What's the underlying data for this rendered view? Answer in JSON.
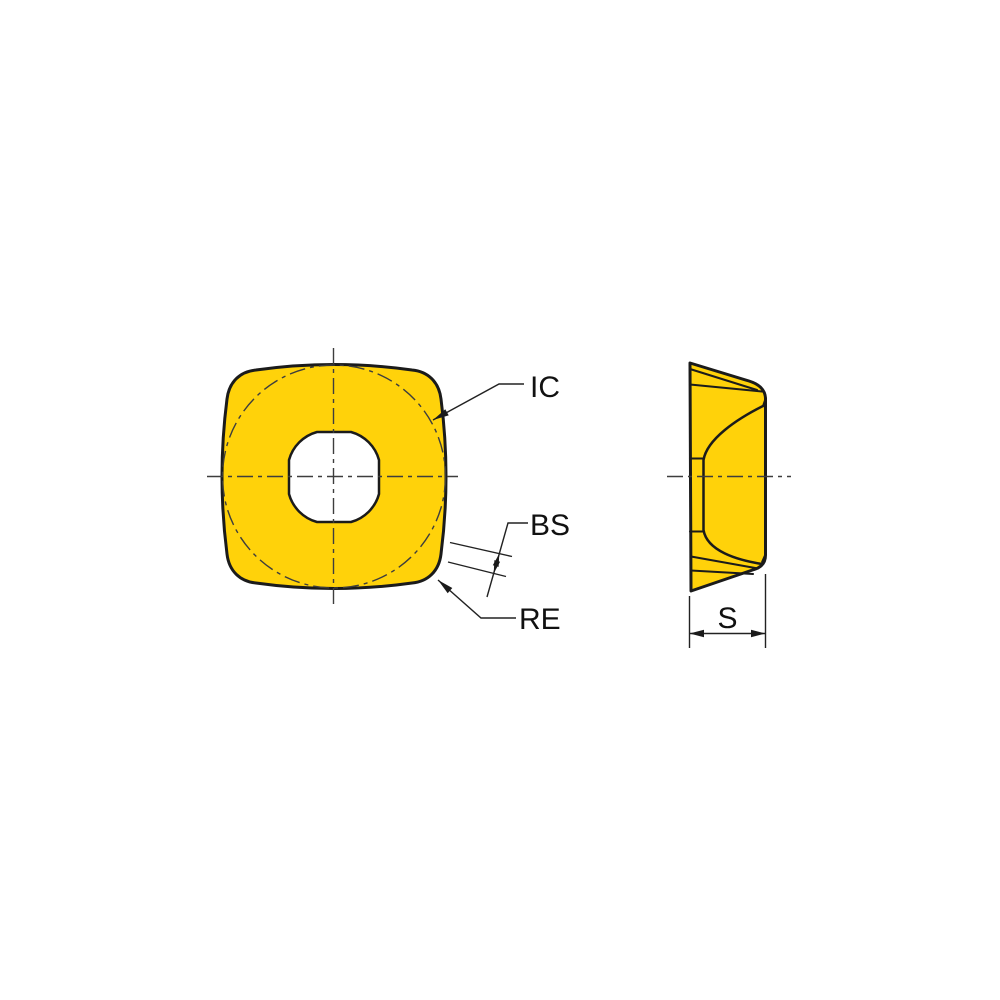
{
  "drawing": {
    "labels": {
      "ic": "IC",
      "bs": "BS",
      "re": "RE",
      "s": "S"
    },
    "colors": {
      "insert_fill": "#FFD20A",
      "hole_fill": "#FFFFFF",
      "line": "#1B1B1B",
      "centerline": "#3D3D3D",
      "background": "#FFFFFF"
    }
  }
}
